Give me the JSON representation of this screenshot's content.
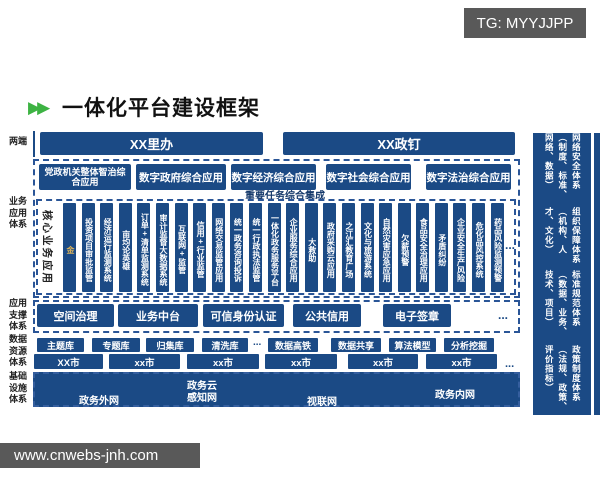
{
  "badges": {
    "tg": "TG: MYYJJPP",
    "site": "www.cnwebs-jnh.com"
  },
  "header": {
    "chevron_icon": "▶▶",
    "title": "一体化平台建设框架"
  },
  "side_labels": {
    "terminals": "两端",
    "business": "业务应用体系",
    "support": "应用支撑体系",
    "data": "数据资源体系",
    "infra": "基础设施体系"
  },
  "terminals": {
    "left": "XX里办",
    "right": "XX政钉"
  },
  "business": {
    "apps": [
      "党政机关整体智治综合应用",
      "数字政府综合应用",
      "数字经济综合应用",
      "数字社会综合应用",
      "数字法治综合应用"
    ],
    "integration_label": "重要任务综合集成",
    "core_label": "核心业务应用",
    "bars": [
      "金",
      "投资项目审批监管",
      "经济运行监测系统",
      "亩均论英雄",
      "订单+清单监测系统",
      "审计监督大数据系统",
      "互联网+监管",
      "信用+行业监管",
      "网络交易监管应用",
      "统一政务咨询投诉",
      "统一行政执法监管",
      "一体化政务服务平台",
      "企业服务综合应用",
      "大救助",
      "政府采购云应用",
      "之江汇教育广场",
      "文化与旅游系统",
      "自然灾害应急应用",
      "欠薪预警",
      "食品安全治理应用",
      "矛盾纠纷",
      "企业安全生产风险",
      "危化品风控系统",
      "药品风险监测预警"
    ],
    "more": "..."
  },
  "support": {
    "items": [
      "空间治理",
      "业务中台",
      "可信身份认证",
      "公共信用",
      "电子签章"
    ],
    "more": "..."
  },
  "data_layer": {
    "libs": [
      "主题库",
      "专题库",
      "归集库",
      "清洗库"
    ],
    "more": "...",
    "services": [
      "数据高铁",
      "数据共享",
      "算法模型",
      "分析挖掘"
    ]
  },
  "cities": {
    "items": [
      "XX市",
      "xx市",
      "xx市",
      "xx市",
      "xx市",
      "xx市"
    ],
    "more": "..."
  },
  "infra": {
    "networks": [
      "政务外网",
      "政务云",
      "感知网",
      "视联网",
      "政务内网"
    ]
  },
  "pillars": {
    "items": [
      "网络安全体系（制度、标准、网络、数据）",
      "组织保障体系（机构、人才、文化）",
      "标准规范体系（数据、业务、技术、项目）",
      "政策制度体系（法规、政策、评价指标）"
    ]
  },
  "colors": {
    "navy": "#1b4a85",
    "dash_border": "#2a5597",
    "badge_gray": "#595959",
    "chevron_green": "#3db343",
    "gold_text": "#d9b25c"
  }
}
